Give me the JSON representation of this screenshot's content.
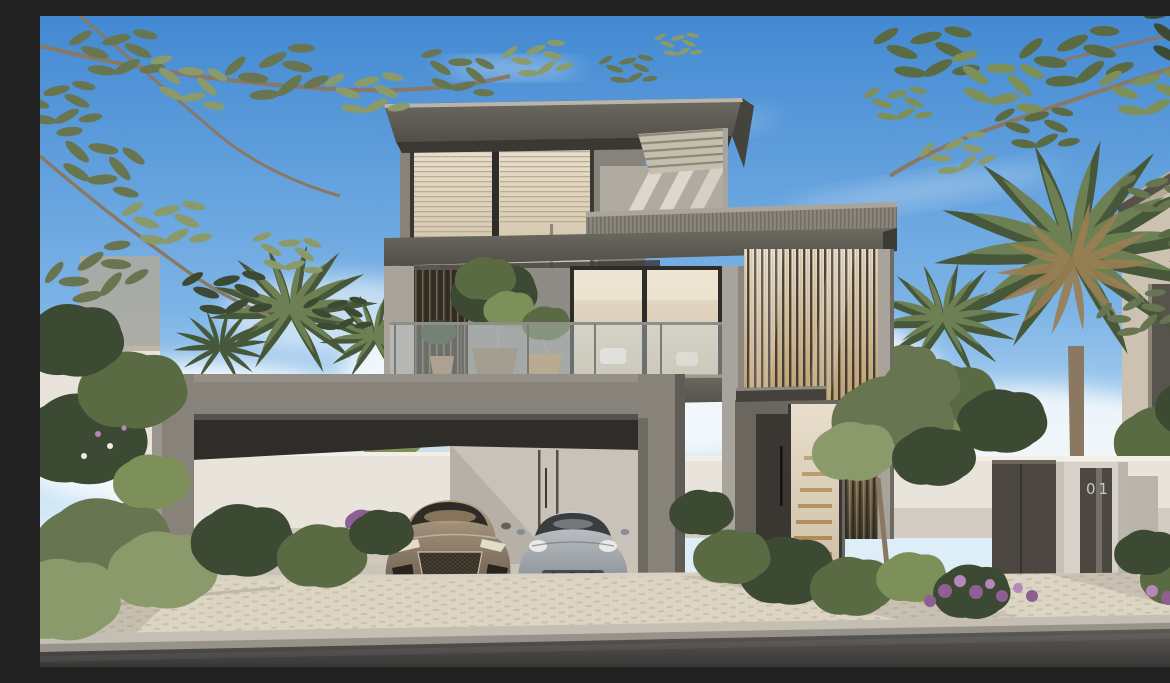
{
  "scene": {
    "title": "Photorealistic rendering of a modern three-storey luxury villa with carport, two sports cars, palm trees and landscaped front garden",
    "house_number": "01",
    "objects": [
      "villa",
      "cantilevered-flat-roofs",
      "roof-terrace-pergola",
      "corrugated-parapet",
      "balcony-with-glass-balustrade",
      "potted-plants",
      "floor-to-ceiling-glazing",
      "vertical-timber-louvres",
      "marble-feature-wall",
      "carport-portal-frame",
      "sports-car-bronze",
      "sports-car-silver",
      "entrance-door",
      "interior-staircase",
      "perimeter-white-wall",
      "gate-pillar-with-number",
      "metal-gate-panels",
      "palm-trees",
      "olive-tree-branches",
      "purple-flower-beds",
      "paver-sidewalk",
      "concrete-curb",
      "asphalt-road",
      "blue-sky-with-clouds",
      "neighbouring-building"
    ]
  },
  "colors": {
    "sky_top": "#4389d2",
    "sky_mid": "#7db4e6",
    "sky_horizon": "#ddeef8",
    "cloud": "#f6fafc",
    "roof_dark": "#6d6a62",
    "roof_edge": "#524f48",
    "concrete_light": "#a8a49c",
    "concrete_mid": "#87837b",
    "concrete_dark": "#6a675f",
    "concrete_deep": "#45423c",
    "corrugate": "#8a857c",
    "marble": "#8e8c87",
    "glass_warm_hi": "#e9decd",
    "glass_warm_lo": "#cdbfa4",
    "glass_cool": "#c9d4da",
    "blind": "#c3b494",
    "louver_dark": "#3a352c",
    "timber": "#b89a6d",
    "interior_dark": "#312f2a",
    "wall_white": "#e9e4db",
    "wall_shade": "#d2ccc2",
    "metal_panel": "#4c4841",
    "number_text": "#cbc8c2",
    "backwall": "#b6b0a6",
    "paver": "#ddd5c4",
    "paver_line": "#b4aa94",
    "driveway": "#d7d0c3",
    "curb_top": "#c4beb3",
    "curb_face": "#98938a",
    "road_hi": "#5d5b56",
    "road_lo": "#393836",
    "green_dark": "#3d4a33",
    "green_mid": "#5a6b44",
    "green_light": "#7d9059",
    "olive": "#677550",
    "olive_light": "#8a9a6b",
    "palm_dark": "#47583a",
    "palm_mid": "#6d8054",
    "trunk": "#8a7863",
    "flower_purple": "#8e5f93",
    "flower_light": "#b687ba",
    "car_bronze_hi": "#b3a189",
    "car_bronze_lo": "#6e6051",
    "car_silver_hi": "#c8ccd0",
    "car_silver_lo": "#878d93",
    "tire": "#1d1c1a",
    "shadow": "#2a2823",
    "neighbor": "#cdc2b1",
    "neighbor_shade": "#b4a996"
  }
}
